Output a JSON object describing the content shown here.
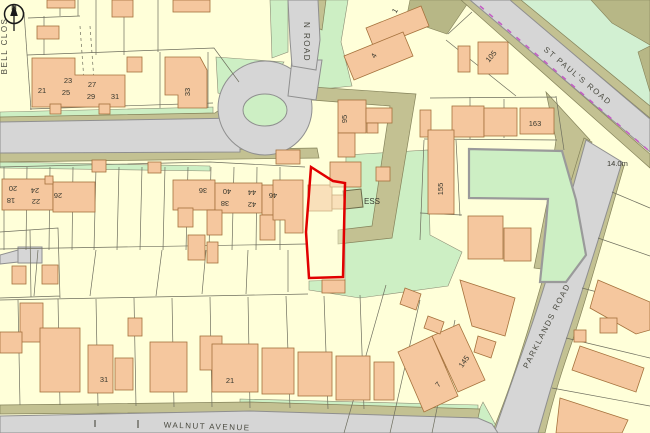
{
  "map": {
    "compass": {
      "north_label": "N"
    },
    "roads": {
      "bell_close": "BELL CLOS",
      "top_road": "N ROAD",
      "st_pauls": "ST PAUL'S ROAD",
      "parklands": "PARKLANDS ROAD",
      "walnut": "WALNUT AVENUE"
    },
    "annotations": {
      "spot_height": "14.0m",
      "substation": "ESS"
    },
    "house_numbers": {
      "tl21": "21",
      "tl23": "23",
      "tl25": "25",
      "tl27": "27",
      "tl29": "29",
      "tl31": "31",
      "t33": "33",
      "m18": "18",
      "m20": "20",
      "m22": "22",
      "m24": "24",
      "m26": "26",
      "m36": "36",
      "m38": "38",
      "m40": "40",
      "m42": "42",
      "m44": "44",
      "m46": "46",
      "c95": "95",
      "d1": "1",
      "d4": "4",
      "r105": "105",
      "r163": "163",
      "r155": "155",
      "b31": "31",
      "b21": "21",
      "b7": "7",
      "b145": "145"
    },
    "colors": {
      "parcel_fill": "#FFFFD9",
      "building_fill": "#F5C79E",
      "road_fill": "#D6D6D6",
      "verge_fill": "#C3C192",
      "green_fill": "#CDEFC4",
      "site_boundary": "#E10000",
      "boundary_dashes": "#C45FC4"
    }
  }
}
